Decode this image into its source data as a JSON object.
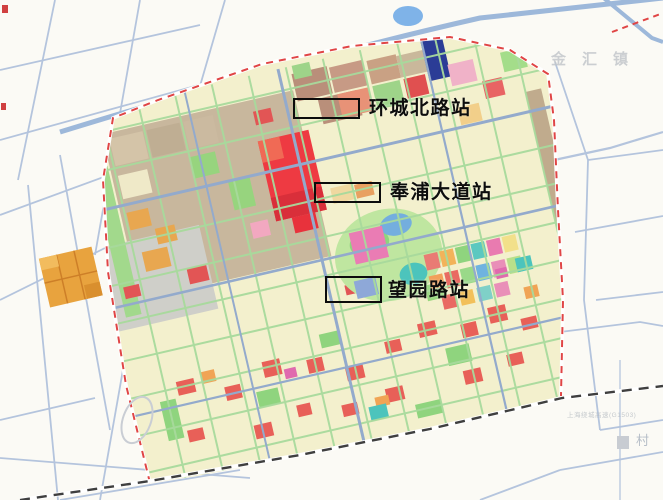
{
  "map": {
    "stations": [
      {
        "name": "环城北路站"
      },
      {
        "name": "奉浦大道站"
      },
      {
        "name": "望园路站"
      }
    ],
    "region_labels": {
      "town": "金汇镇",
      "village": "村",
      "expressway": "上海绕城高速(G1503)"
    },
    "colors": {
      "background": "#fbfaf5",
      "water_line": "#a9bdd9",
      "area_base": "#f3f0cd",
      "tan_block": "#c8b79d",
      "red_block": "#ee3a42",
      "park_green": "#9ed489",
      "boundary_dash": "#e04545",
      "railway_dash": "#3f3f3f",
      "callout_border": "#0c0c0c",
      "orange_block": "#e8a33e"
    }
  }
}
